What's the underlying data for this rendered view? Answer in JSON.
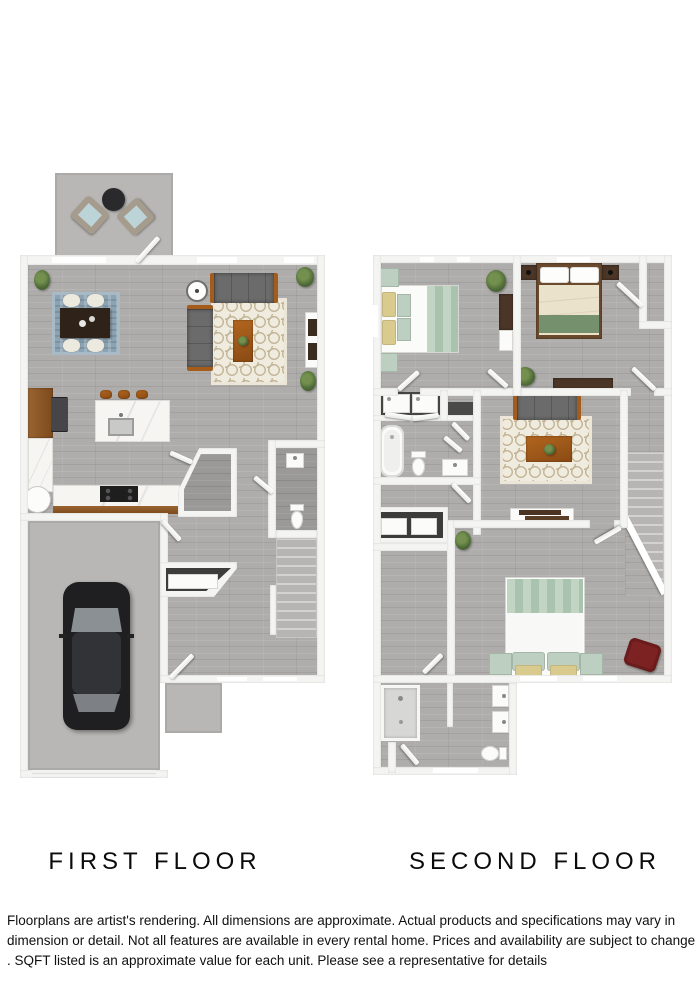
{
  "first_floor": {
    "label": "FIRST FLOOR"
  },
  "second_floor": {
    "label": "SECOND FLOOR"
  },
  "disclaimer": {
    "line1": "Floorplans are artist's rendering. All dimensions are approximate. Actual products and specifications may vary in",
    "line2": "dimension or detail. Not all features are available in every rental home. Prices and availability are subject to change",
    "line3": ". SQFT listed is an approximate value for each unit. Please see a representative for details"
  },
  "colors": {
    "wall": "#f4f4f2",
    "floor_wood": "#aeadab",
    "concrete": "#b8b7b5",
    "rug_cream": "#f0ebdf",
    "rug_blue": "#8ba3b3",
    "sofa_gray": "#6b6b6b",
    "wood_cognac": "#a55c1b",
    "wood_dark": "#4a3526",
    "mint": "#bccfc0",
    "sage_green": "#74906e",
    "butter_yellow": "#d9ca8e",
    "accent_red": "#7c2222",
    "car_black": "#1f1f21"
  }
}
